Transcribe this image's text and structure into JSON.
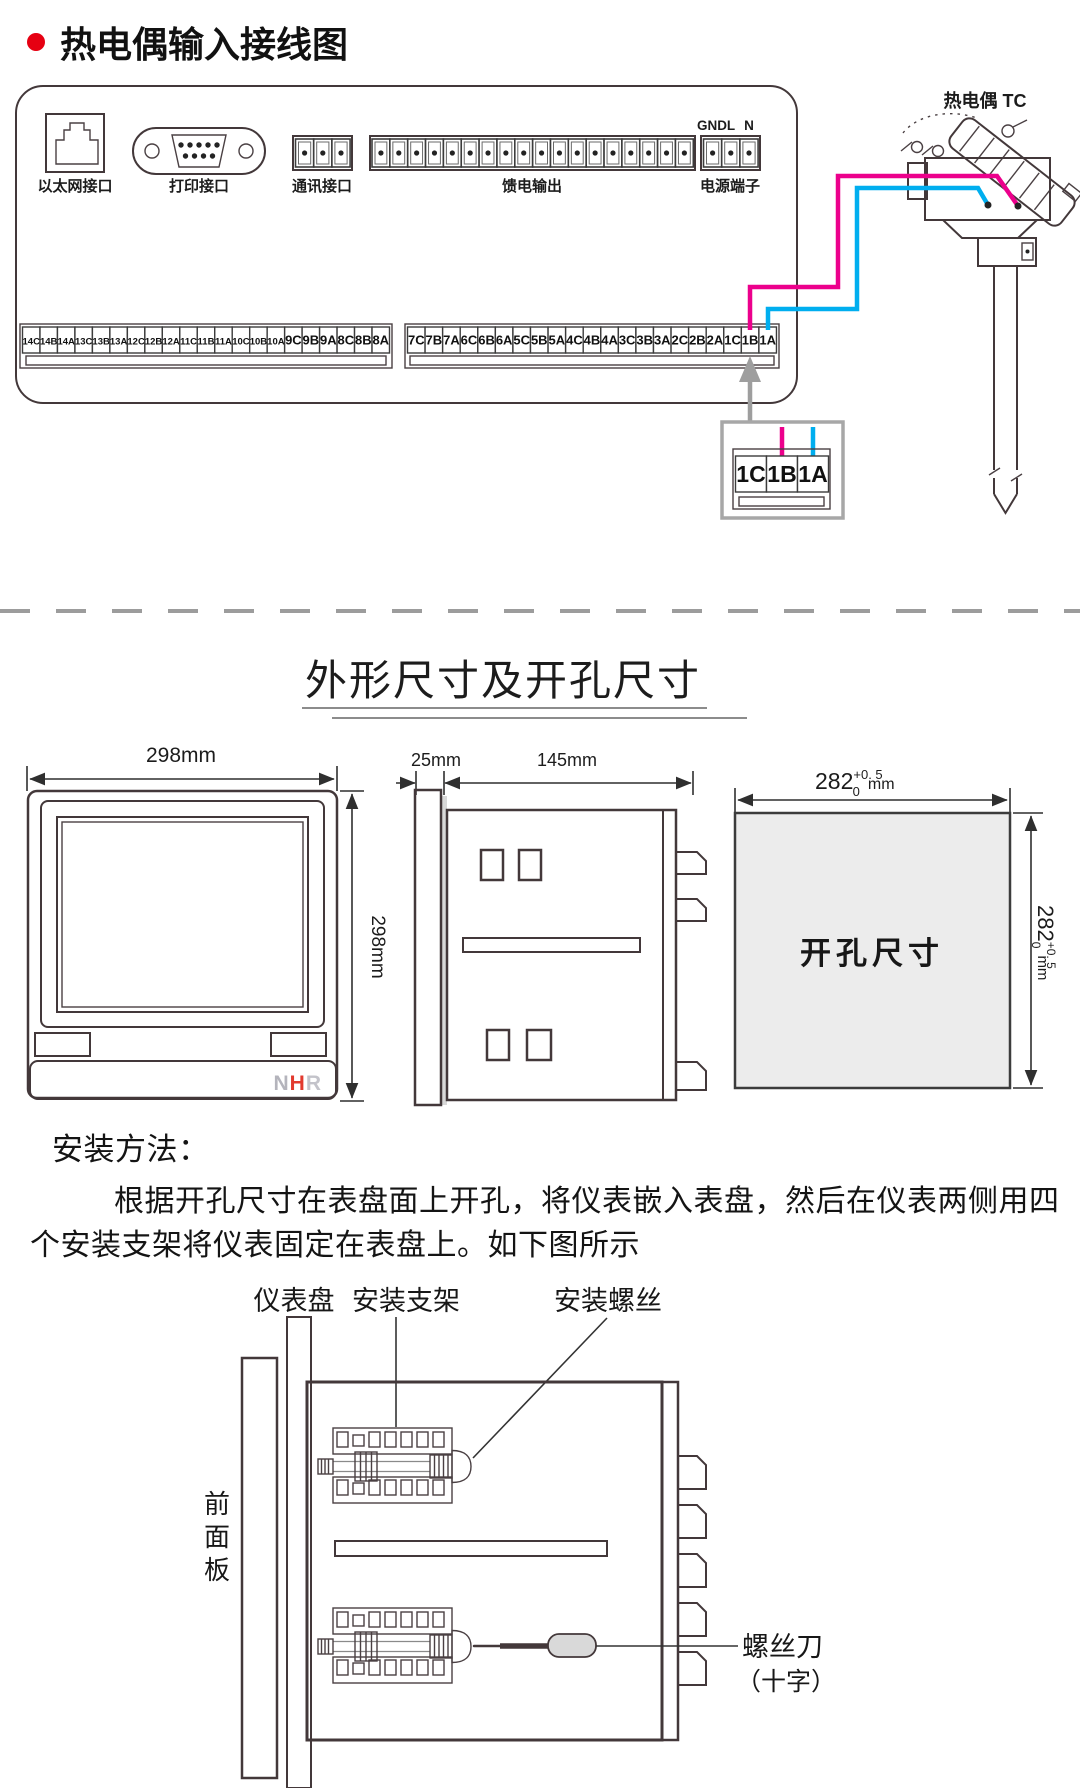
{
  "header": {
    "title": "热电偶输入接线图",
    "bullet_color": "#e60012"
  },
  "wiring": {
    "ethernet_label": "以太网接口",
    "printer_label": "打印接口",
    "comm_label": "通讯接口",
    "feed_label": "馈电输出",
    "power_label": "电源端子",
    "power_pins": [
      "GND",
      "L",
      "N"
    ],
    "left_terminals": [
      "14C",
      "14B",
      "14A",
      "13C",
      "13B",
      "13A",
      "12C",
      "12B",
      "12A",
      "11C",
      "11B",
      "11A",
      "10C",
      "10B",
      "10A",
      "9C",
      "9B",
      "9A",
      "8C",
      "8B",
      "8A"
    ],
    "right_terminals": [
      "7C",
      "7B",
      "7A",
      "6C",
      "6B",
      "6A",
      "5C",
      "5B",
      "5A",
      "4C",
      "4B",
      "4A",
      "3C",
      "3B",
      "3A",
      "2C",
      "2B",
      "2A",
      "1C",
      "1B",
      "1A"
    ],
    "callout_terminals": [
      "1C",
      "1B",
      "1A"
    ],
    "tc_label": "热电偶 TC",
    "wire_positive_color": "#ec008c",
    "wire_negative_color": "#00aeef"
  },
  "dims": {
    "section_title": "外形尺寸及开孔尺寸",
    "front_width": "298mm",
    "front_height": "298mm",
    "bezel_depth": "25mm",
    "body_depth": "145mm",
    "cutout_value": "282",
    "cutout_sup": "+0. 5",
    "cutout_sub": "0",
    "cutout_unit": "mm",
    "cutout_area_label": "开孔尺寸",
    "brand": "NHR",
    "brand_colors": [
      "#b4b4bc",
      "#e23a2e",
      "#c3c3ca"
    ]
  },
  "install": {
    "heading": "安装方法：",
    "line1": "根据开孔尺寸在表盘面上开孔，将仪表嵌入表盘，然后在仪表两侧用四",
    "line2": "个安装支架将仪表固定在表盘上。如下图所示",
    "label_panel": "仪表盘",
    "label_bracket": "安装支架",
    "label_screw": "安装螺丝",
    "label_front_panel": "前面板",
    "label_screwdriver": "螺丝刀",
    "label_screwdriver_sub": "（十字）"
  }
}
